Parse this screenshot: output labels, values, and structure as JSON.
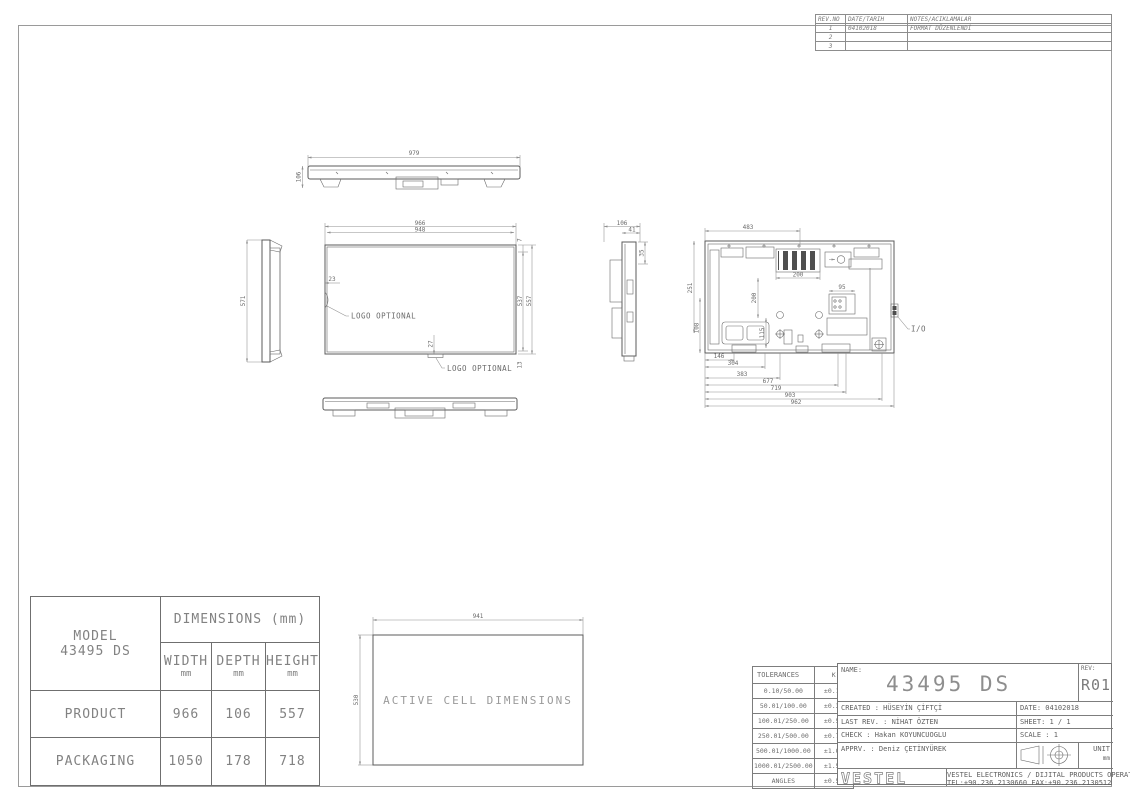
{
  "revision_table": {
    "headers": {
      "rev_no": "REV.NO",
      "date": "DATE/TARIH",
      "notes": "NOTES/ACIKLAMALAR"
    },
    "rows": [
      {
        "no": "1",
        "date": "04102018",
        "note": "FORMAT DÜZENLENDİ"
      },
      {
        "no": "2",
        "date": "",
        "note": ""
      },
      {
        "no": "3",
        "date": "",
        "note": ""
      }
    ]
  },
  "views": {
    "top": {
      "dim_width": "979",
      "dim_depth": "106"
    },
    "left_side": {
      "dim_height": "571"
    },
    "front": {
      "dim_outer_width": "966",
      "dim_inner_width": "948",
      "dim_top_bezel": "7",
      "dim_inner_height": "537",
      "dim_outer_height": "557",
      "dim_bottom_bezel": "13",
      "dim_logo_side": "23",
      "dim_logo_bottom": "27",
      "logo_label_left": "LOGO OPTIONAL",
      "logo_label_bottom": "LOGO OPTIONAL"
    },
    "right_side": {
      "dim_depth": "106",
      "dim_top": "41",
      "dim_side": "35"
    },
    "rear": {
      "dim_top": "483",
      "dim_vent_width": "200",
      "dim_vesa_v": "200",
      "dim_mid": "115",
      "dim_conn": "95",
      "dim_left_upper": "251",
      "dim_left_lower": "108",
      "chain": [
        "146",
        "304",
        "383",
        "677",
        "719",
        "903",
        "962"
      ],
      "io_label": "I/O"
    },
    "active_cell": {
      "label": "ACTIVE CELL DIMENSIONS",
      "dim_width": "941",
      "dim_height": "530"
    }
  },
  "model_table": {
    "model_label": "MODEL",
    "model_value": "43495 DS",
    "dims_header": "DIMENSIONS (mm)",
    "col1": "WIDTH",
    "col2": "DEPTH",
    "col3": "HEIGHT",
    "unit": "mm",
    "rows": [
      {
        "label": "PRODUCT",
        "width": "966",
        "depth": "106",
        "height": "557"
      },
      {
        "label": "PACKAGING",
        "width": "1050",
        "depth": "178",
        "height": "718"
      }
    ]
  },
  "title_block": {
    "tolerances": {
      "header_left": "TOLERANCES",
      "header_right": "K",
      "rows": [
        {
          "range": "0.10/50.00",
          "tol": "±0.10"
        },
        {
          "range": "50.01/100.00",
          "tol": "±0.30"
        },
        {
          "range": "100.01/250.00",
          "tol": "±0.50"
        },
        {
          "range": "250.01/500.00",
          "tol": "±0.75"
        },
        {
          "range": "500.01/1000.00",
          "tol": "±1.00"
        },
        {
          "range": "1000.01/2500.00",
          "tol": "±1.50"
        },
        {
          "range": "ANGLES",
          "tol": "±0.5°"
        }
      ]
    },
    "name_label": "NAME:",
    "name_value": "43495 DS",
    "rev_label": "REV:",
    "rev_value": "R01",
    "created": "CREATED : HÜSEYİN ÇİFTÇİ",
    "date": "DATE: 04102018",
    "last_rev": "LAST REV. : NİHAT ÖZTEN",
    "sheet": "SHEET: 1 / 1",
    "check": "CHECK : Hakan KOYUNCUOGLU",
    "scale": "SCALE : 1",
    "apprv": "APPRV. : Deniz ÇETİNYÜREK",
    "unit_label": "UNIT",
    "unit_value": "mm",
    "logo": "VESTEL",
    "company_line1": "VESTEL ELECTRONICS / DIJITAL PRODUCTS OPERATIONS MANISA/TURKIYE",
    "company_line2": "TEL:+90.236.2130660 FAX:+90.236.2130512"
  }
}
